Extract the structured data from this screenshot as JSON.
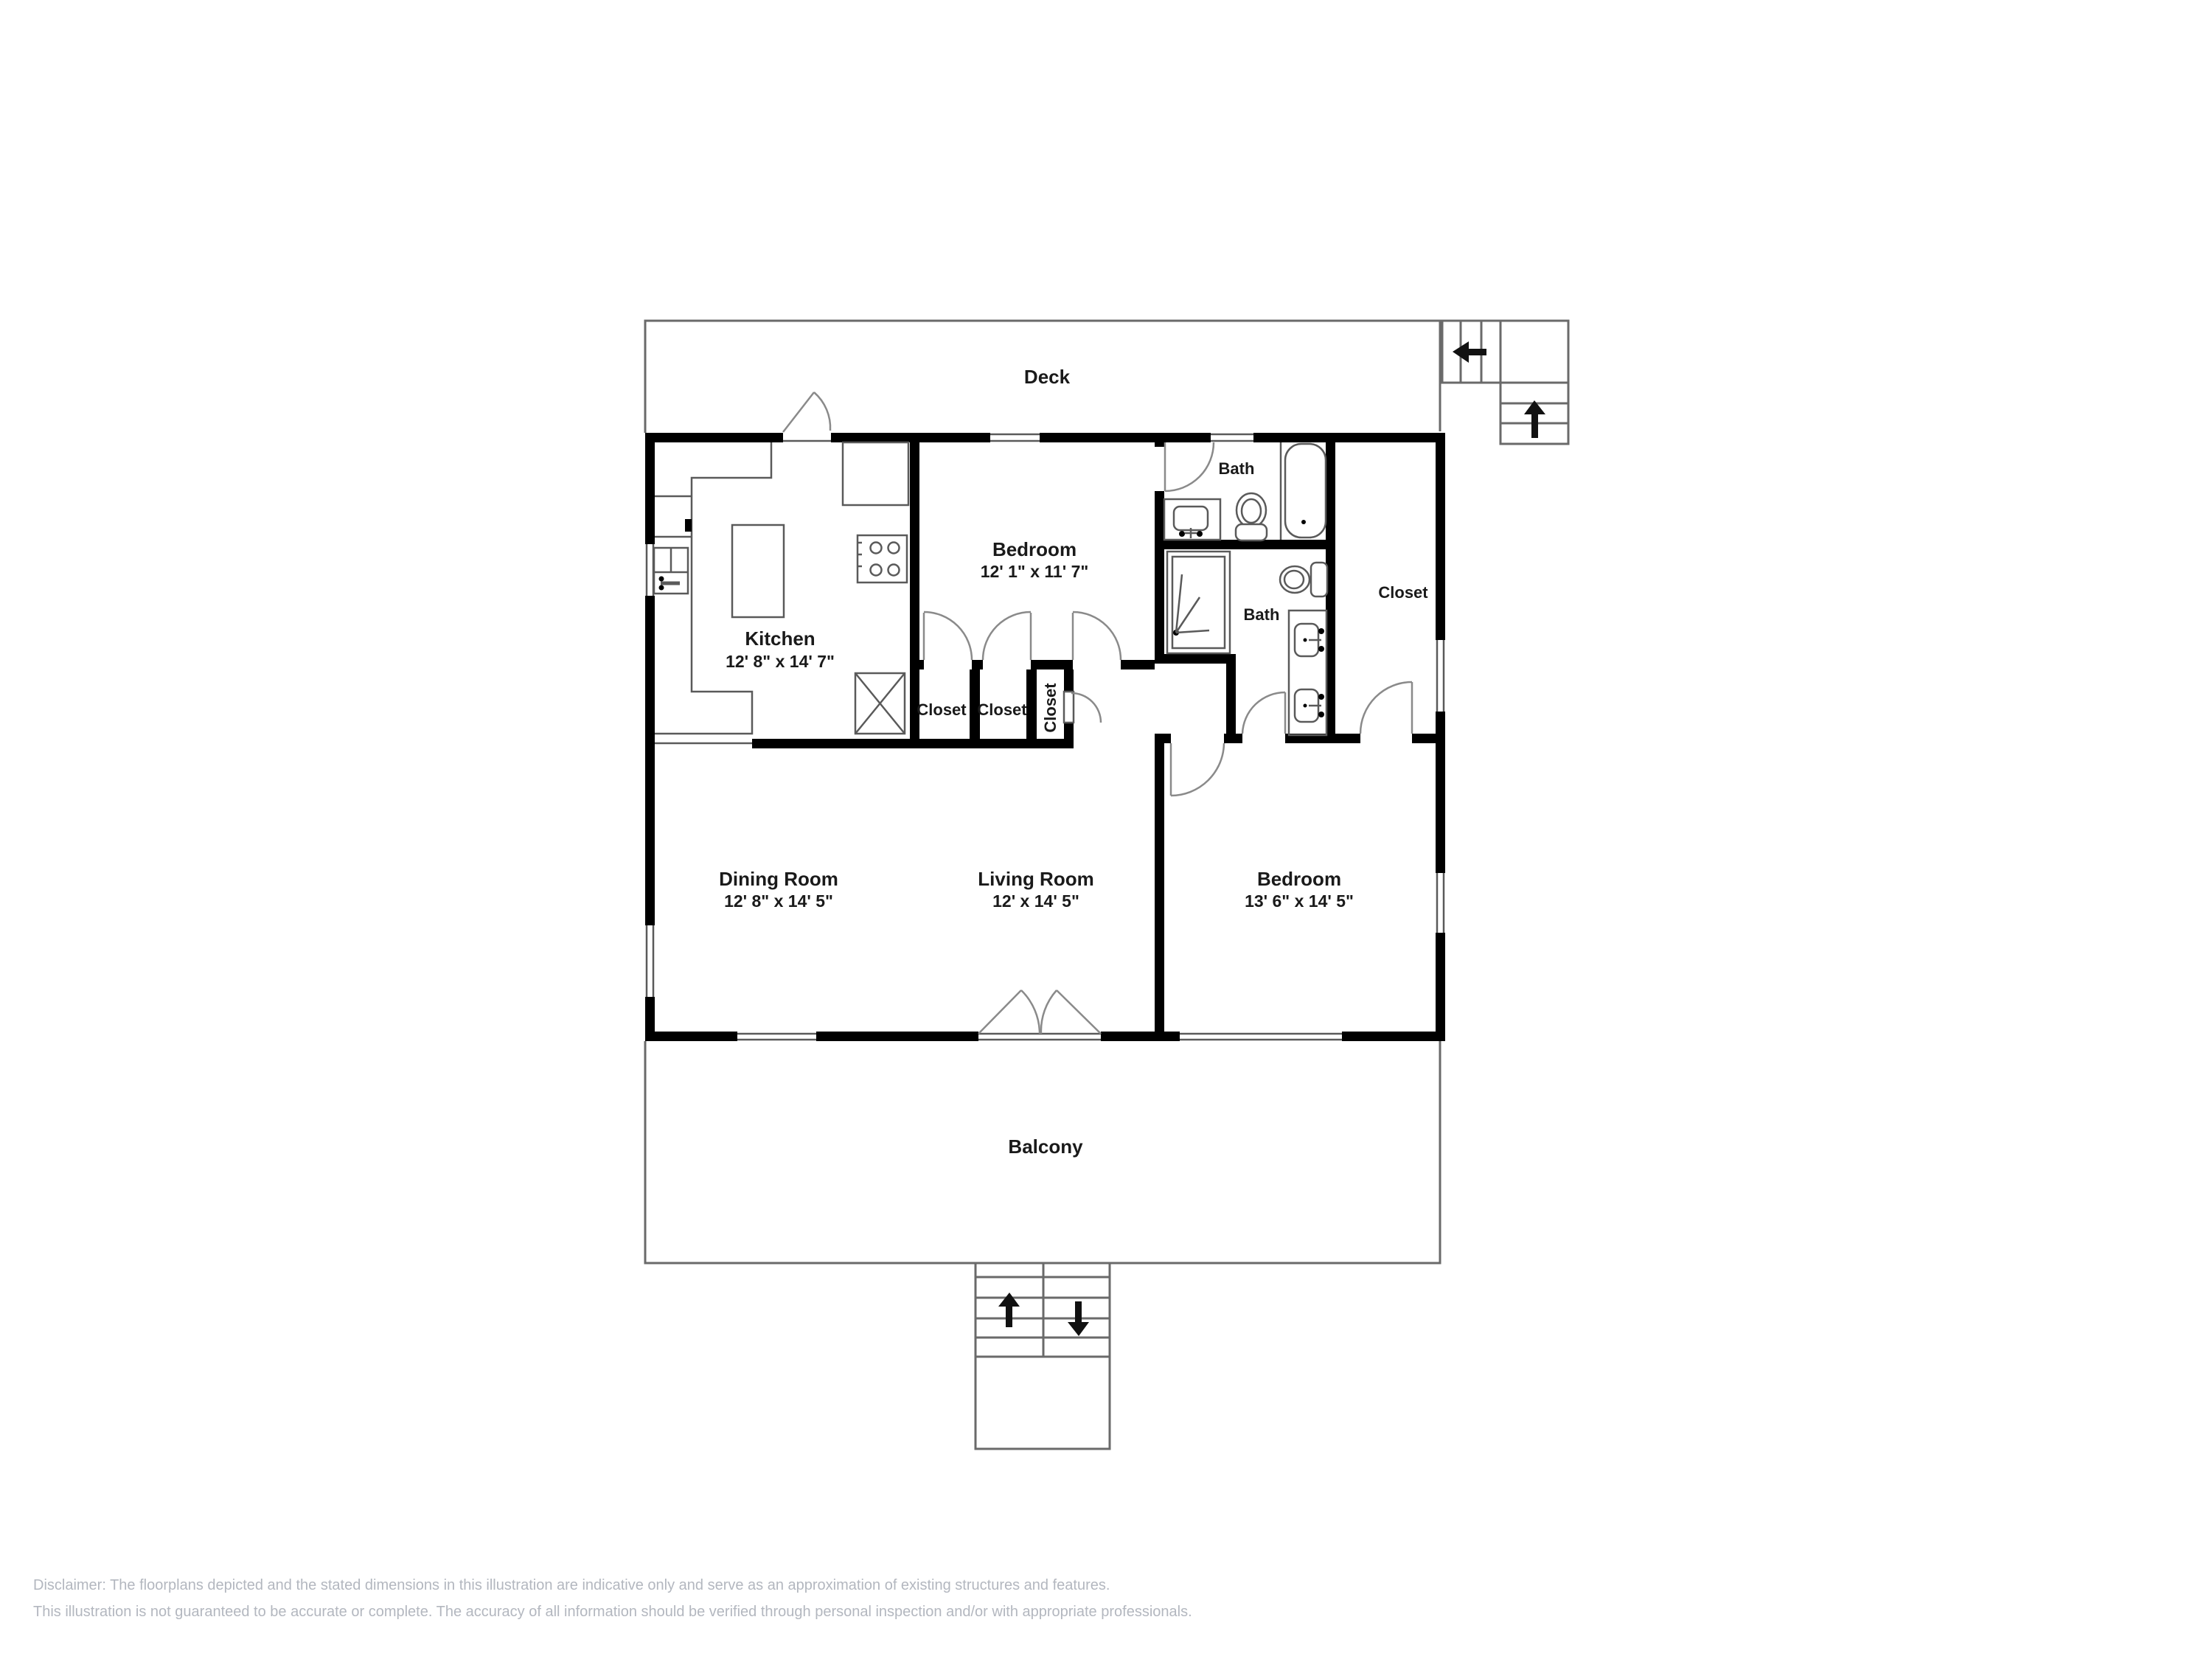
{
  "floorplan": {
    "rooms": {
      "deck": {
        "label": "Deck"
      },
      "kitchen": {
        "label": "Kitchen",
        "dims": "12' 8\" x 14' 7\""
      },
      "bedroom1": {
        "label": "Bedroom",
        "dims": "12' 1\" x 11' 7\""
      },
      "bath1": {
        "label": "Bath"
      },
      "bath2": {
        "label": "Bath"
      },
      "closet_walkin": {
        "label": "Closet"
      },
      "closet1": {
        "label": "Closet"
      },
      "closet2": {
        "label": "Closet"
      },
      "closet3": {
        "label": "Closet"
      },
      "dining": {
        "label": "Dining Room",
        "dims": "12' 8\" x 14' 5\""
      },
      "living": {
        "label": "Living Room",
        "dims": "12' x 14' 5\""
      },
      "bedroom2": {
        "label": "Bedroom",
        "dims": "13' 6\" x 14' 5\""
      },
      "balcony": {
        "label": "Balcony"
      }
    },
    "disclaimer": {
      "line1": "Disclaimer: The floorplans depicted and the stated dimensions in this illustration are indicative only and serve as an approximation of existing structures and features.",
      "line2": "This illustration is not guaranteed to be accurate or complete. The accuracy of all information should be verified through personal inspection and/or with appropriate professionals."
    },
    "colors": {
      "wall": "#000000",
      "thin_line": "#5a5a5a",
      "arc": "#8a8a8a",
      "disclaimer_text": "#b3b7bf"
    }
  }
}
